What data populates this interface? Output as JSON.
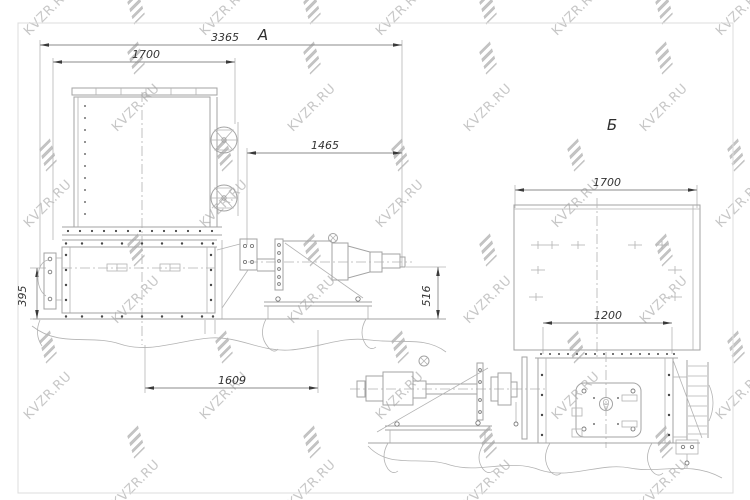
{
  "drawing": {
    "type": "technical-assembly-drawing",
    "views": {
      "a": {
        "label": "А",
        "dims": {
          "overall_length": "3365",
          "body_width": "1700",
          "drive_span": "1465",
          "frame_height": "395",
          "base_span": "1609",
          "drive_height": "516"
        }
      },
      "b": {
        "label": "Б",
        "dims": {
          "body_width": "1700",
          "base_width": "1200"
        }
      }
    },
    "line_color": "#a3a3a3",
    "dim_text_color": "#333333"
  },
  "watermarks": {
    "text": "KVZR.RU",
    "color": "#c7c7c7",
    "items": [
      {
        "t": "B",
        "x": 136,
        "y": 8
      },
      {
        "t": "B",
        "x": 312,
        "y": 8
      },
      {
        "t": "B",
        "x": 488,
        "y": 8
      },
      {
        "t": "B",
        "x": 664,
        "y": 8
      },
      {
        "t": "T",
        "x": 48,
        "y": 12
      },
      {
        "t": "T",
        "x": 224,
        "y": 12
      },
      {
        "t": "T",
        "x": 400,
        "y": 12
      },
      {
        "t": "T",
        "x": 576,
        "y": 12
      },
      {
        "t": "T",
        "x": 740,
        "y": 12
      },
      {
        "t": "B",
        "x": 136,
        "y": 58
      },
      {
        "t": "B",
        "x": 312,
        "y": 58
      },
      {
        "t": "B",
        "x": 488,
        "y": 58
      },
      {
        "t": "B",
        "x": 664,
        "y": 58
      },
      {
        "t": "T",
        "x": 136,
        "y": 108
      },
      {
        "t": "T",
        "x": 312,
        "y": 108
      },
      {
        "t": "T",
        "x": 488,
        "y": 108
      },
      {
        "t": "T",
        "x": 664,
        "y": 108
      },
      {
        "t": "B",
        "x": 48,
        "y": 155
      },
      {
        "t": "B",
        "x": 224,
        "y": 155
      },
      {
        "t": "B",
        "x": 400,
        "y": 155
      },
      {
        "t": "B",
        "x": 576,
        "y": 155
      },
      {
        "t": "B",
        "x": 736,
        "y": 155
      },
      {
        "t": "T",
        "x": 48,
        "y": 204
      },
      {
        "t": "T",
        "x": 224,
        "y": 204
      },
      {
        "t": "T",
        "x": 400,
        "y": 204
      },
      {
        "t": "T",
        "x": 576,
        "y": 204
      },
      {
        "t": "T",
        "x": 740,
        "y": 204
      },
      {
        "t": "B",
        "x": 136,
        "y": 250
      },
      {
        "t": "B",
        "x": 312,
        "y": 250
      },
      {
        "t": "B",
        "x": 488,
        "y": 250
      },
      {
        "t": "B",
        "x": 664,
        "y": 250
      },
      {
        "t": "T",
        "x": 136,
        "y": 300
      },
      {
        "t": "T",
        "x": 312,
        "y": 300
      },
      {
        "t": "T",
        "x": 488,
        "y": 300
      },
      {
        "t": "T",
        "x": 664,
        "y": 300
      },
      {
        "t": "B",
        "x": 48,
        "y": 347
      },
      {
        "t": "B",
        "x": 224,
        "y": 347
      },
      {
        "t": "B",
        "x": 400,
        "y": 347
      },
      {
        "t": "B",
        "x": 576,
        "y": 347
      },
      {
        "t": "B",
        "x": 736,
        "y": 347
      },
      {
        "t": "T",
        "x": 48,
        "y": 396
      },
      {
        "t": "T",
        "x": 224,
        "y": 396
      },
      {
        "t": "T",
        "x": 400,
        "y": 396
      },
      {
        "t": "T",
        "x": 576,
        "y": 396
      },
      {
        "t": "T",
        "x": 740,
        "y": 396
      },
      {
        "t": "B",
        "x": 136,
        "y": 442
      },
      {
        "t": "B",
        "x": 312,
        "y": 442
      },
      {
        "t": "B",
        "x": 488,
        "y": 442
      },
      {
        "t": "B",
        "x": 664,
        "y": 442
      },
      {
        "t": "T",
        "x": 136,
        "y": 484
      },
      {
        "t": "T",
        "x": 312,
        "y": 484
      },
      {
        "t": "T",
        "x": 488,
        "y": 484
      },
      {
        "t": "T",
        "x": 664,
        "y": 484
      }
    ]
  }
}
